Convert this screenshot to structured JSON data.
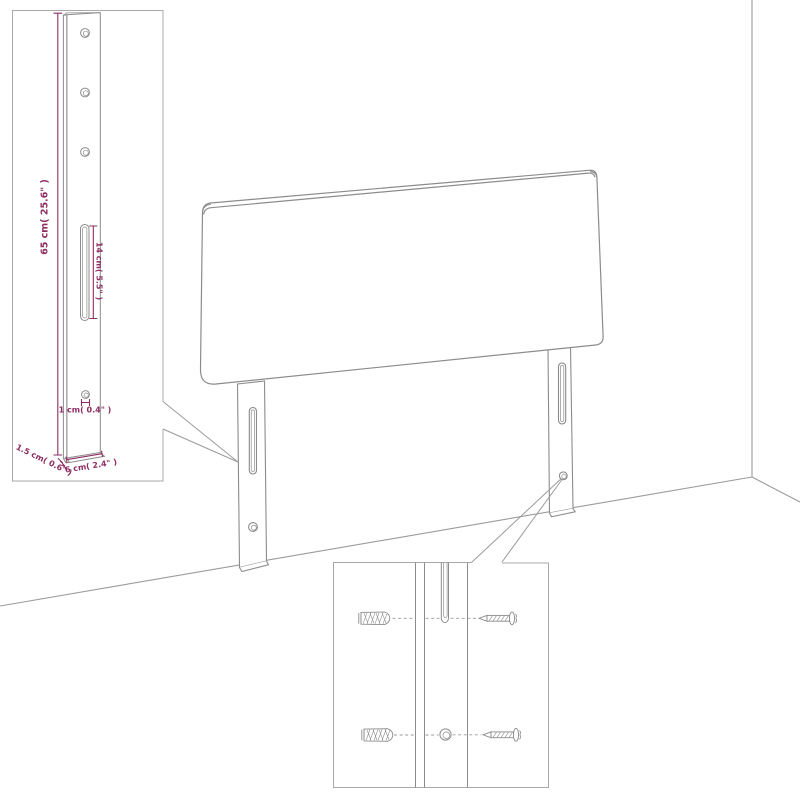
{
  "colors": {
    "line_art": "#8c8c8c",
    "wall_line": "#9b9b9b",
    "inset_border": "#a8a8a8",
    "dimension": "#8e2e63",
    "background": "#ffffff"
  },
  "diagram": {
    "subject": "headboard with two wall-mount legs shown against a room corner",
    "insets": [
      {
        "id": "leg-detail",
        "description": "enlarged side view of mounting leg with holes and slot"
      },
      {
        "id": "mount-detail",
        "description": "enlarged view of slot and round hole with wall plugs and screws"
      }
    ],
    "icons": [
      "wall-plug-icon",
      "screw-icon",
      "mounting-slot",
      "mounting-hole"
    ]
  },
  "dimensions": {
    "height": "65 cm( 25.6\" )",
    "slot_length": "14 cm( 5.5\" )",
    "hole_diameter": "1 cm( 0.4\" )",
    "thickness": "1.5 cm( 0.6\" )",
    "width": "6 cm( 2.4\" )"
  }
}
